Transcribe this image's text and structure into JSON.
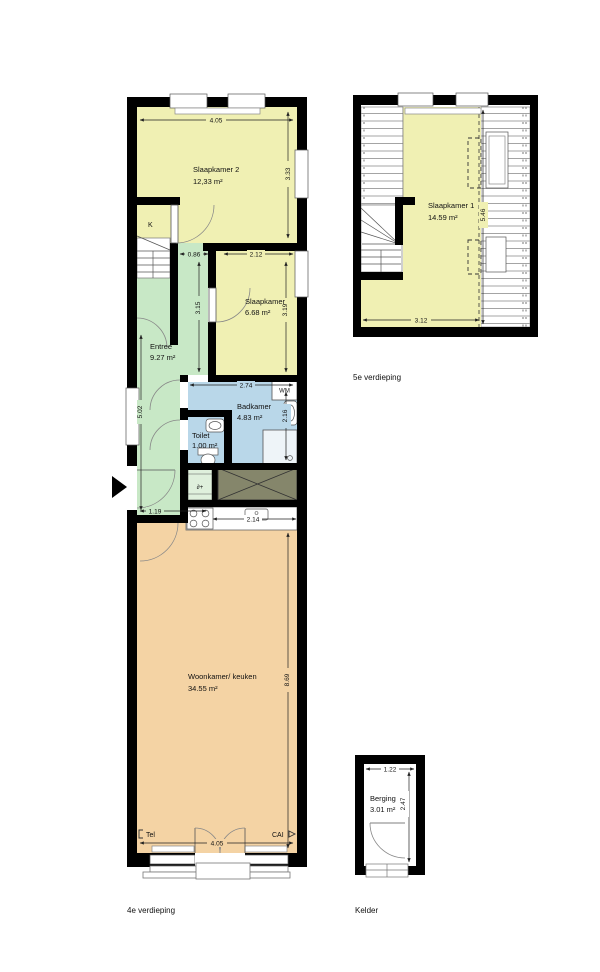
{
  "plans": {
    "fourth": {
      "label": "4e verdieping",
      "rooms": {
        "slaapkamer2": {
          "name": "Slaapkamer 2",
          "area": "12,33 m²"
        },
        "slaapkamer": {
          "name": "Slaapkamer",
          "area": "6.68 m²"
        },
        "entree": {
          "name": "Entree",
          "area": "9.27 m²"
        },
        "badkamer": {
          "name": "Badkamer",
          "area": "4.83 m²"
        },
        "toilet": {
          "name": "Toilet",
          "area": "1.00 m²"
        },
        "woonkamer": {
          "name": "Woonkamer/ keuken",
          "area": "34.55 m²"
        }
      },
      "dims": {
        "top_width": "4.05",
        "slaapkamer2_height": "3.33",
        "hall_width": "0.86",
        "slaapkamer_width": "2.12",
        "hall_height": "3.15",
        "slaapkamer_height": "3.19",
        "badkamer_width": "2.74",
        "badkamer_height": "2.16",
        "entree_height": "5.02",
        "entree_width": "1.19",
        "kitchen_width": "2.14",
        "woonkamer_height": "8.69",
        "bottom_width": "4.05"
      },
      "annotations": {
        "closet": "K",
        "washer": "WM",
        "meter": "∂+",
        "tel": "Tel",
        "cai": "CAI"
      }
    },
    "fifth": {
      "label": "5e verdieping",
      "rooms": {
        "slaapkamer1": {
          "name": "Slaapkamer 1",
          "area": "14.59 m²"
        }
      },
      "dims": {
        "width": "3.12",
        "height": "5.46"
      }
    },
    "kelder": {
      "label": "Kelder",
      "rooms": {
        "berging": {
          "name": "Berging",
          "area": "3.01 m²"
        }
      },
      "dims": {
        "width": "1.22",
        "height": "2.47"
      }
    }
  },
  "colors": {
    "bedroom_yellow": "#f0f0b3",
    "hall_green": "#c8e8c6",
    "bath_blue": "#b9d7e9",
    "living_orange": "#f4d3a4",
    "shaft_olive": "#85866b",
    "wall_black": "#000000"
  }
}
